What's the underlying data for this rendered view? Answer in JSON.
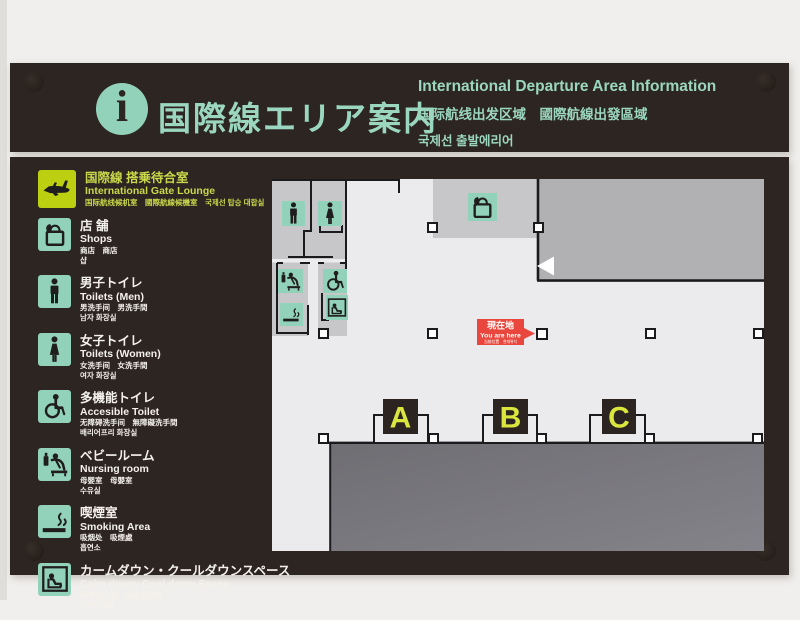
{
  "header": {
    "title_jp": "国際線エリア案内",
    "title_en": "International Departure Area Information",
    "title_cn": "国际航线出发区域　國際航線出發區域",
    "title_kr": "국제선 출발에리어",
    "info_icon_glyph": "i"
  },
  "legend": {
    "items": [
      {
        "icon": "airplane-icon",
        "title": "国際線 搭乗待合室",
        "en": "International Gate Lounge",
        "line3": "国际航线候机室　國際航線候機室　국제선 탑승 대합실",
        "line4": ""
      },
      {
        "icon": "shopping-bag-icon",
        "title": "店 舗",
        "en": "Shops",
        "line3": "商店　商店",
        "line4": "샵"
      },
      {
        "icon": "man-icon",
        "title": "男子トイレ",
        "en": "Toilets (Men)",
        "line3": "男洗手间　男洗手間",
        "line4": "남자 화장실"
      },
      {
        "icon": "woman-icon",
        "title": "女子トイレ",
        "en": "Toilets (Women)",
        "line3": "女洗手间　女洗手間",
        "line4": "여자 화장실"
      },
      {
        "icon": "wheelchair-icon",
        "title": "多機能トイレ",
        "en": "Accesible Toilet",
        "line3": "无障碍洗手间　無障礙洗手間",
        "line4": "배리어프리 화장실"
      },
      {
        "icon": "nursing-room-icon",
        "title": "ベビールーム",
        "en": "Nursing room",
        "line3": "母婴室　母嬰室",
        "line4": "수유실"
      },
      {
        "icon": "smoking-icon",
        "title": "喫煙室",
        "en": "Smoking Area",
        "line3": "吸烟处　吸煙處",
        "line4": "흡연소"
      },
      {
        "icon": "calm-down-icon",
        "title": "カームダウン・クールダウンスペース",
        "en": "Calm down, Cool down Space",
        "line3": "情绪安抚室　情緒安撫室",
        "line4": "심리안정실"
      }
    ]
  },
  "map": {
    "gates": [
      "A",
      "B",
      "C"
    ],
    "you_are_here": {
      "jp": "現在地",
      "en": "You are here",
      "sub": "当前位置　현재위치"
    }
  },
  "colors": {
    "board": "#2d2521",
    "accent_teal": "#93d2ba",
    "accent_yellow": "#bccf10",
    "gate_letter_yellow": "#dae63e",
    "you_are_here_red": "#e9473d",
    "map_background": "#ebebed",
    "room_gray": "#c7c7c9",
    "block_gray": "#b1b1b4",
    "restricted_gray": "#77767b"
  }
}
